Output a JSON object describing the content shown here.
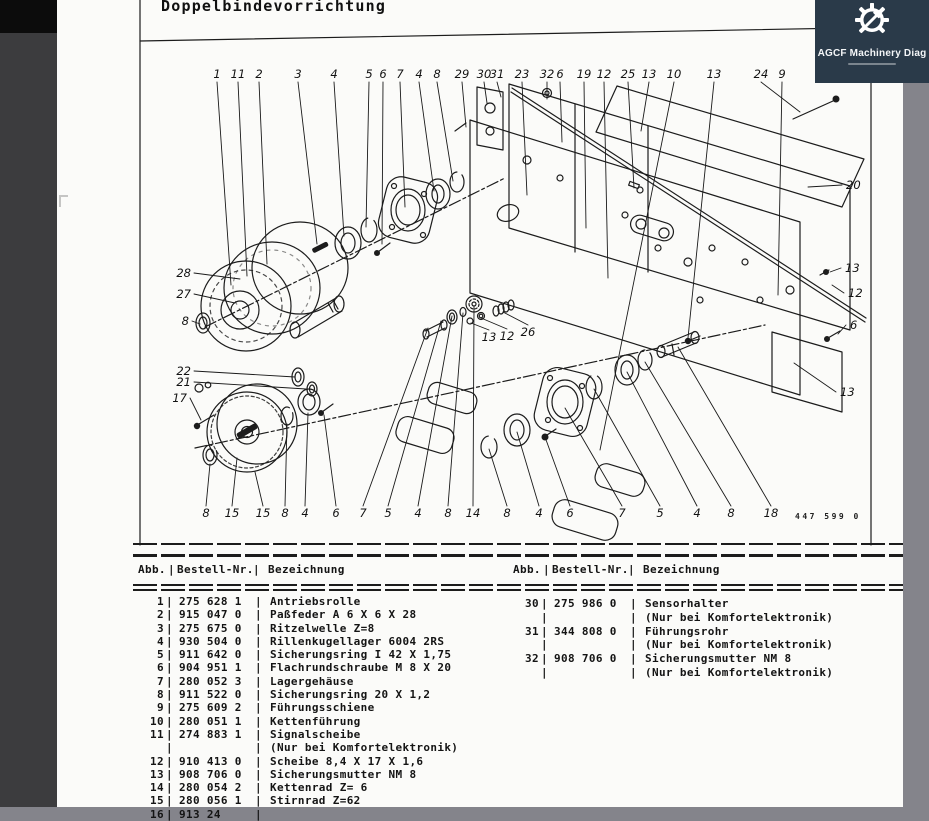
{
  "colors": {
    "app_bg": "#84848b",
    "page_bg": "#fbfbf9",
    "left_strip": "#3c3c3e",
    "logo_bg": "#2a3a49",
    "ink": "#1c1c1c"
  },
  "viewer": {
    "logo": {
      "title": "AGCF Machinery Diag"
    }
  },
  "page": {
    "title": "Doppelbindevorrichtung",
    "drawing_number": "447 599 0",
    "parts_table": {
      "headers": {
        "abb": "Abb.",
        "nr": "Bestell-Nr.",
        "name": "Bezeichnung"
      },
      "left_rows": [
        {
          "abb": "1",
          "nr": "275 628 1",
          "name": "Antriebsrolle"
        },
        {
          "abb": "2",
          "nr": "915 047 0",
          "name": "Paßfeder A 6 X 6 X 28"
        },
        {
          "abb": "3",
          "nr": "275 675 0",
          "name": "Ritzelwelle Z=8"
        },
        {
          "abb": "4",
          "nr": "930 504 0",
          "name": "Rillenkugellager 6004 2RS"
        },
        {
          "abb": "5",
          "nr": "911 642 0",
          "name": "Sicherungsring I 42 X 1,75"
        },
        {
          "abb": "6",
          "nr": "904 951 1",
          "name": "Flachrundschraube M 8 X 20"
        },
        {
          "abb": "7",
          "nr": "280 052 3",
          "name": "Lagergehäuse"
        },
        {
          "abb": "8",
          "nr": "911 522 0",
          "name": "Sicherungsring 20 X 1,2"
        },
        {
          "abb": "9",
          "nr": "275 609 2",
          "name": "Führungsschiene"
        },
        {
          "abb": "10",
          "nr": "280 051 1",
          "name": "Kettenführung"
        },
        {
          "abb": "11",
          "nr": "274 883 1",
          "name": "Signalscheibe"
        },
        {
          "abb": "",
          "nr": "",
          "name": "(Nur bei Komfortelektronik)"
        },
        {
          "abb": "12",
          "nr": "910 413 0",
          "name": "Scheibe 8,4 X 17 X 1,6"
        },
        {
          "abb": "13",
          "nr": "908 706 0",
          "name": "Sicherungsmutter NM 8"
        },
        {
          "abb": "14",
          "nr": "280 054 2",
          "name": "Kettenrad Z= 6"
        },
        {
          "abb": "15",
          "nr": "280 056 1",
          "name": "Stirnrad Z=62"
        },
        {
          "abb": "16",
          "nr": "913 24",
          "name": ""
        }
      ],
      "right_rows": [
        {
          "abb": "30",
          "nr": "275 986 0",
          "name": "Sensorhalter"
        },
        {
          "abb": "",
          "nr": "",
          "name": "(Nur bei Komfortelektronik)"
        },
        {
          "abb": "31",
          "nr": "344 808 0",
          "name": "Führungsrohr"
        },
        {
          "abb": "",
          "nr": "",
          "name": "(Nur bei Komfortelektronik)"
        },
        {
          "abb": "32",
          "nr": "908 706 0",
          "name": "Sicherungsmutter NM 8"
        },
        {
          "abb": "",
          "nr": "",
          "name": "(Nur bei Komfortelektronik)"
        }
      ]
    },
    "diagram": {
      "callouts": {
        "top": [
          {
            "label": "1",
            "x": 217,
            "y": 78,
            "tx": 231,
            "ty": 285
          },
          {
            "label": "11",
            "x": 238,
            "y": 78,
            "tx": 247,
            "ty": 276
          },
          {
            "label": "2",
            "x": 259,
            "y": 78,
            "tx": 267,
            "ty": 264
          },
          {
            "label": "3",
            "x": 298,
            "y": 78,
            "tx": 317,
            "ty": 244
          },
          {
            "label": "4",
            "x": 334,
            "y": 78,
            "tx": 344,
            "ty": 236
          },
          {
            "label": "5",
            "x": 369,
            "y": 78,
            "tx": 366,
            "ty": 227
          },
          {
            "label": "6",
            "x": 383,
            "y": 78,
            "tx": 382,
            "ty": 244
          },
          {
            "label": "7",
            "x": 400,
            "y": 78,
            "tx": 405,
            "ty": 207
          },
          {
            "label": "4",
            "x": 419,
            "y": 78,
            "tx": 434,
            "ty": 191
          },
          {
            "label": "8",
            "x": 437,
            "y": 78,
            "tx": 453,
            "ty": 181
          },
          {
            "label": "29",
            "x": 462,
            "y": 78,
            "tx": 466,
            "ty": 127
          },
          {
            "label": "30",
            "x": 484,
            "y": 78,
            "tx": 487,
            "ty": 103
          },
          {
            "label": "31",
            "x": 497,
            "y": 78,
            "tx": 501,
            "ty": 97
          },
          {
            "label": "23",
            "x": 522,
            "y": 78,
            "tx": 527,
            "ty": 195
          },
          {
            "label": "32",
            "x": 547,
            "y": 78,
            "tx": 547,
            "ty": 99
          },
          {
            "label": "6",
            "x": 560,
            "y": 78,
            "tx": 562,
            "ty": 142
          },
          {
            "label": "19",
            "x": 584,
            "y": 78,
            "tx": 586,
            "ty": 228
          },
          {
            "label": "12",
            "x": 604,
            "y": 78,
            "tx": 608,
            "ty": 278
          },
          {
            "label": "25",
            "x": 628,
            "y": 78,
            "tx": 634,
            "ty": 188
          },
          {
            "label": "13",
            "x": 649,
            "y": 78,
            "tx": 641,
            "ty": 131
          },
          {
            "label": "10",
            "x": 674,
            "y": 78,
            "tx": 600,
            "ty": 450
          },
          {
            "label": "13",
            "x": 714,
            "y": 78,
            "tx": 688,
            "ty": 338
          },
          {
            "label": "24",
            "x": 761,
            "y": 78,
            "tx": 800,
            "ty": 112
          },
          {
            "label": "9",
            "x": 782,
            "y": 78,
            "tx": 778,
            "ty": 295
          }
        ],
        "bottom": [
          {
            "label": "8",
            "x": 206,
            "y": 517,
            "tx": 210,
            "ty": 464
          },
          {
            "label": "15",
            "x": 232,
            "y": 517,
            "tx": 237,
            "ty": 458
          },
          {
            "label": "15",
            "x": 263,
            "y": 517,
            "tx": 255,
            "ty": 472
          },
          {
            "label": "8",
            "x": 285,
            "y": 517,
            "tx": 287,
            "ty": 424
          },
          {
            "label": "4",
            "x": 305,
            "y": 517,
            "tx": 308,
            "ty": 413
          },
          {
            "label": "6",
            "x": 336,
            "y": 517,
            "tx": 324,
            "ty": 415
          },
          {
            "label": "7",
            "x": 363,
            "y": 517,
            "tx": 428,
            "ty": 328
          },
          {
            "label": "5",
            "x": 388,
            "y": 517,
            "tx": 441,
            "ty": 321
          },
          {
            "label": "4",
            "x": 418,
            "y": 517,
            "tx": 452,
            "ty": 316
          },
          {
            "label": "8",
            "x": 448,
            "y": 517,
            "tx": 463,
            "ty": 313
          },
          {
            "label": "14",
            "x": 473,
            "y": 517,
            "tx": 474,
            "ty": 307
          },
          {
            "label": "8",
            "x": 507,
            "y": 517,
            "tx": 489,
            "ty": 449
          },
          {
            "label": "4",
            "x": 539,
            "y": 517,
            "tx": 517,
            "ty": 432
          },
          {
            "label": "6",
            "x": 570,
            "y": 517,
            "tx": 545,
            "ty": 437
          },
          {
            "label": "7",
            "x": 622,
            "y": 517,
            "tx": 565,
            "ty": 408
          },
          {
            "label": "5",
            "x": 660,
            "y": 517,
            "tx": 594,
            "ty": 389
          },
          {
            "label": "4",
            "x": 697,
            "y": 517,
            "tx": 627,
            "ty": 372
          },
          {
            "label": "8",
            "x": 731,
            "y": 517,
            "tx": 645,
            "ty": 362
          },
          {
            "label": "18",
            "x": 771,
            "y": 517,
            "tx": 678,
            "ty": 347
          }
        ],
        "left": [
          {
            "label": "28",
            "x": 191,
            "y": 277,
            "tx": 240,
            "ty": 279
          },
          {
            "label": "27",
            "x": 191,
            "y": 298,
            "tx": 235,
            "ty": 303
          },
          {
            "label": "8",
            "x": 189,
            "y": 325,
            "tx": 200,
            "ty": 324
          },
          {
            "label": "22",
            "x": 191,
            "y": 375,
            "tx": 295,
            "ty": 377
          },
          {
            "label": "21",
            "x": 191,
            "y": 386,
            "tx": 306,
            "ty": 389
          },
          {
            "label": "17",
            "x": 187,
            "y": 402,
            "tx": 201,
            "ty": 420
          }
        ],
        "right": [
          {
            "label": "20",
            "x": 846,
            "y": 189,
            "tx": 808,
            "ty": 187
          },
          {
            "label": "13",
            "x": 845,
            "y": 272,
            "tx": 830,
            "ty": 272
          },
          {
            "label": "12",
            "x": 848,
            "y": 297,
            "tx": 832,
            "ty": 285
          },
          {
            "label": "6",
            "x": 850,
            "y": 329,
            "tx": 838,
            "ty": 334
          },
          {
            "label": "13",
            "x": 840,
            "y": 396,
            "tx": 794,
            "ty": 363
          }
        ],
        "mid": [
          {
            "label": "13",
            "x": 489,
            "y": 341,
            "tx": 471,
            "ty": 323
          },
          {
            "label": "12",
            "x": 507,
            "y": 340,
            "tx": 481,
            "ty": 318
          },
          {
            "label": "26",
            "x": 528,
            "y": 336,
            "tx": 503,
            "ty": 312
          }
        ]
      }
    }
  }
}
